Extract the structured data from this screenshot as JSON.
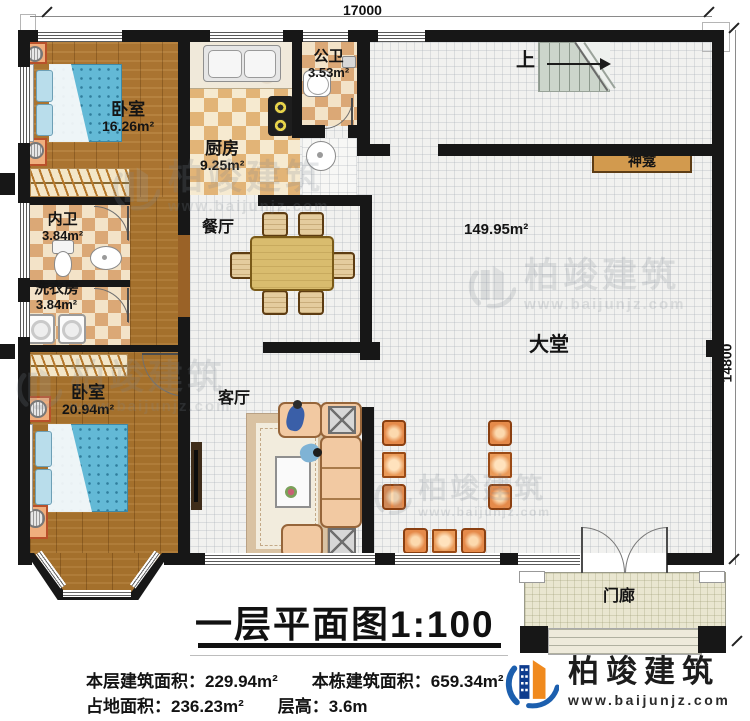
{
  "plan": {
    "dim_top": "17000",
    "dim_right": "14800",
    "up": "上",
    "shrine": "神龛",
    "rooms": {
      "bedroom1": {
        "name": "卧室",
        "area": "16.26m²"
      },
      "kitchen": {
        "name": "厨房",
        "area": "9.25m²"
      },
      "public_bath": {
        "name": "公卫",
        "area": "3.53m²"
      },
      "private_bath": {
        "name": "内卫",
        "area": "3.84m²"
      },
      "laundry": {
        "name": "洗衣房",
        "area": "3.84m²"
      },
      "bedroom2": {
        "name": "卧室",
        "area": "20.94m²"
      },
      "dining": {
        "name": "餐厅"
      },
      "living": {
        "name": "客厅"
      },
      "hall": {
        "name": "大堂",
        "area": "149.95m²"
      },
      "porch": {
        "name": "门廊"
      }
    }
  },
  "title": {
    "text": "一层平面图",
    "scale": "1:100"
  },
  "stats": {
    "floor_area_label": "本层建筑面积：",
    "floor_area": "229.94m²",
    "building_area_label": "本栋建筑面积：",
    "building_area": "659.34m²",
    "footprint_label": "占地面积：",
    "footprint": "236.23m²",
    "height_label": "层高：",
    "height": "3.6m"
  },
  "brand": {
    "name": "柏竣建筑",
    "url": "www.baijunjz.com"
  },
  "watermark": {
    "name": "柏竣建筑",
    "url": "www.baijunjz.com"
  },
  "colors": {
    "wall": "#171717",
    "brand_blue": "#1c5fae",
    "brand_navy": "#0e3c8e",
    "brand_orange": "#f08a1e",
    "wood": "#aa7431",
    "checker_dark": "#e2b477",
    "checker_light": "#f6ead0",
    "shrine_shelf": "#d29a4e",
    "bed_blue": "#63b9d6",
    "chair_orange": "#e58a4a"
  }
}
